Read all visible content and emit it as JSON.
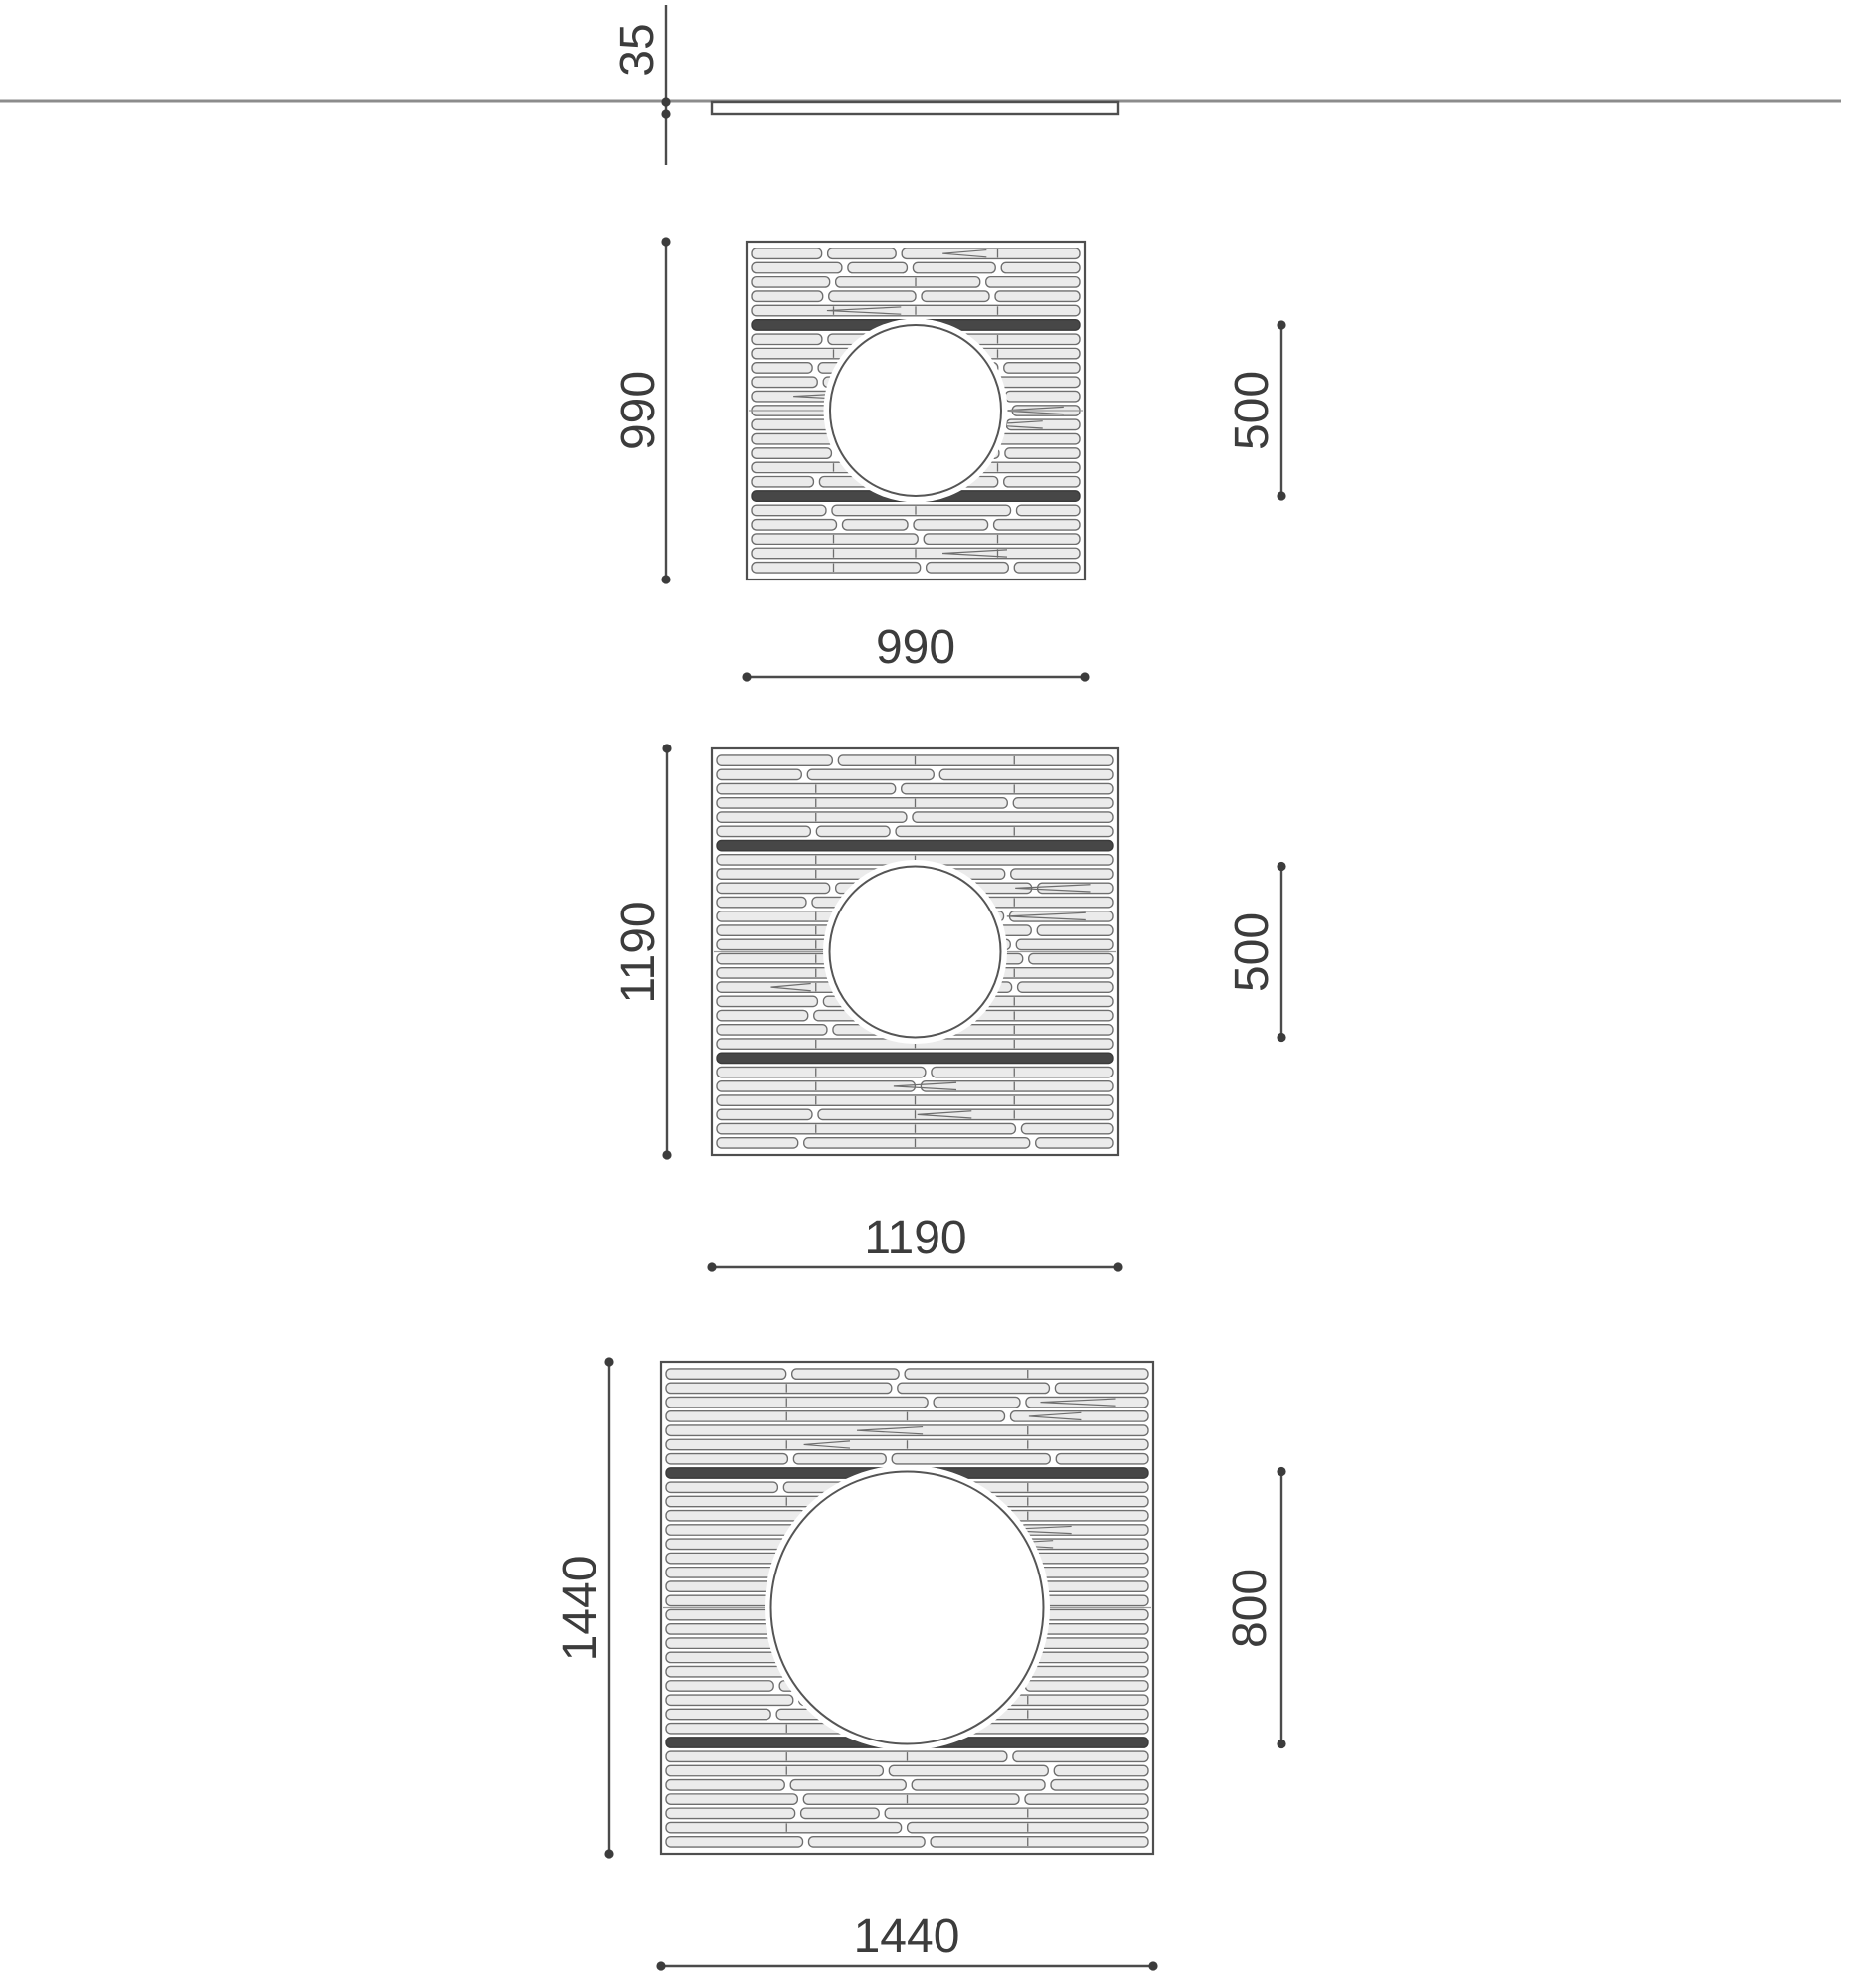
{
  "profile": {
    "thickness_label": "35"
  },
  "grates": [
    {
      "name": "grate-990",
      "left_label": "990",
      "bottom_label": "990",
      "hole_label": "500",
      "size_mm": 990,
      "hole_mm": 500
    },
    {
      "name": "grate-1190",
      "left_label": "1190",
      "bottom_label": "1190",
      "hole_label": "500",
      "size_mm": 1190,
      "hole_mm": 500
    },
    {
      "name": "grate-1440",
      "left_label": "1440",
      "bottom_label": "1440",
      "hole_label": "800",
      "size_mm": 1440,
      "hole_mm": 800
    }
  ],
  "colors": {
    "dim_line": "#4b4b4b",
    "text": "#3c3c3c",
    "ground": "#8c8c8c",
    "border": "#4f4f4f",
    "slat_fill": "#ebebeb",
    "slat_stroke": "#6e6e6e",
    "slat_dark": "#474747",
    "slat_dark_stroke": "#3a3a3a",
    "seam": "#9a9a9a",
    "hole_outline": "#555555"
  }
}
